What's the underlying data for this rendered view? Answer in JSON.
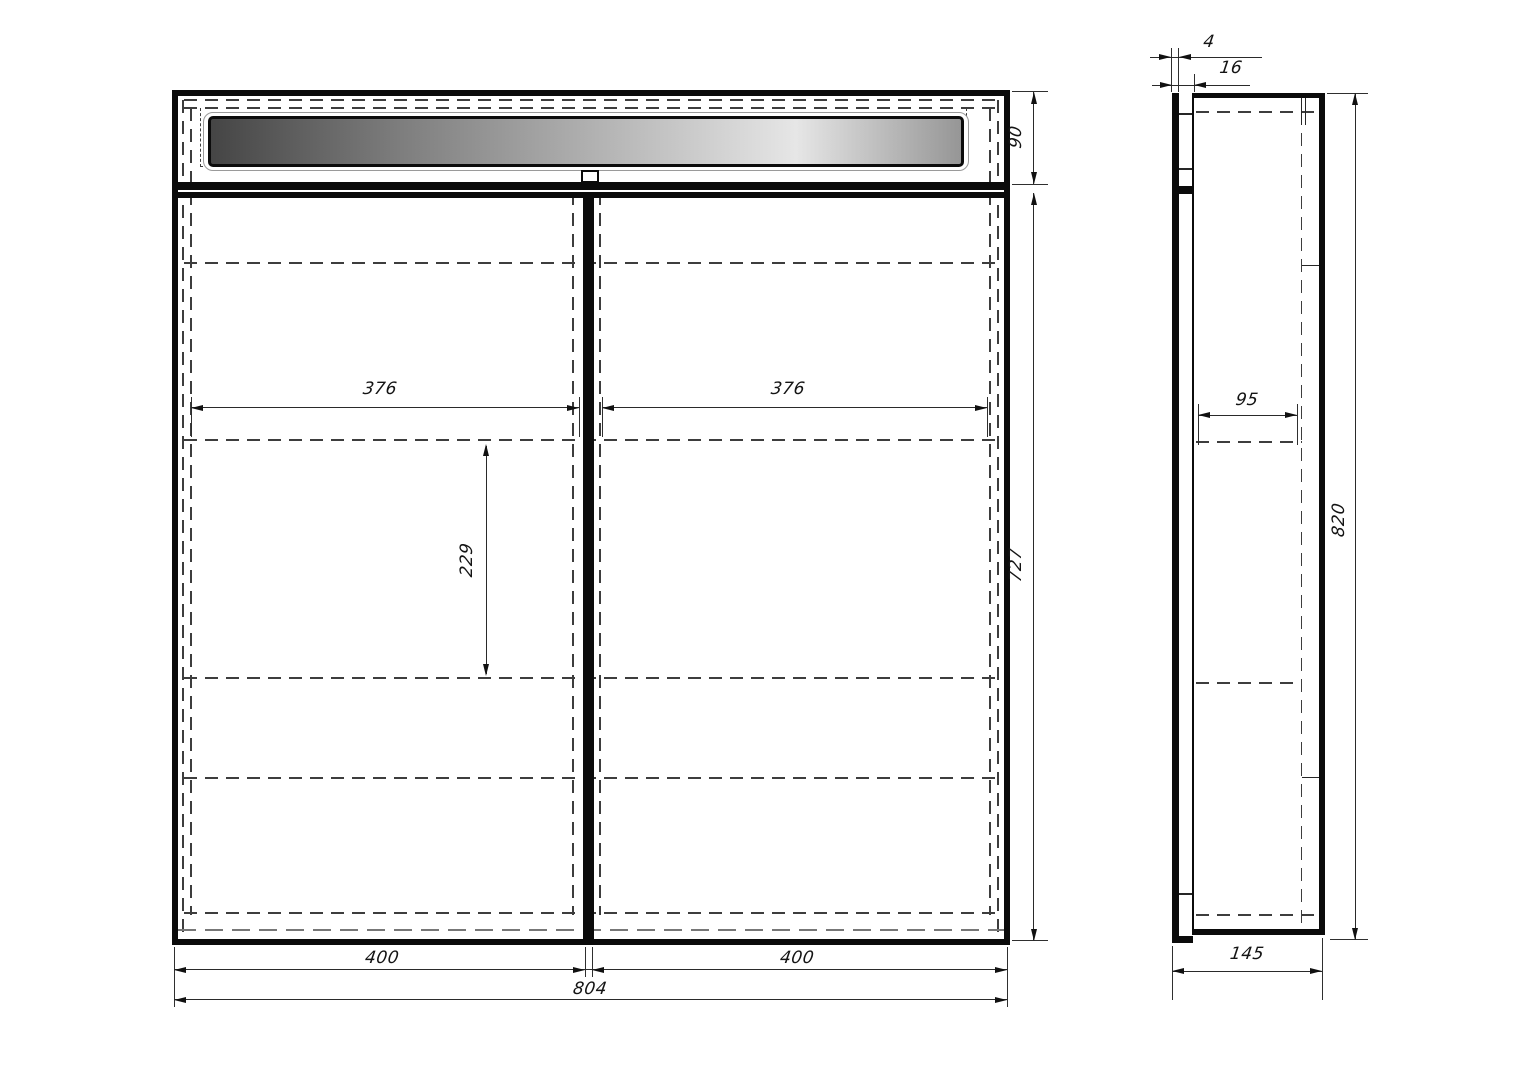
{
  "front_view": {
    "dims": {
      "light_section_height": "90",
      "door_section_height": "727",
      "inner_width_left": "376",
      "inner_width_right": "376",
      "shelf_gap": "229",
      "door_width_left": "400",
      "door_width_right": "400",
      "overall_width": "804"
    }
  },
  "side_view": {
    "dims": {
      "door_thickness": "4",
      "front_depth": "16",
      "shelf_depth": "95",
      "overall_height": "820",
      "overall_depth": "145"
    }
  }
}
